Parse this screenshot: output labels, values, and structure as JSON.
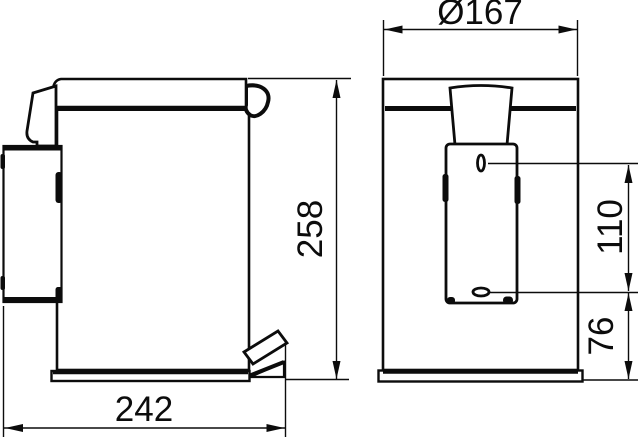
{
  "drawing": {
    "type": "technical-dimension-drawing",
    "views": {
      "side_view_label": "side view of pedal waste bin with wall bracket and foot pedal",
      "rear_view_label": "rear view of pedal waste bin with mounting plate and screw holes"
    },
    "dimensions": {
      "depth": "242",
      "height": "258",
      "diameter": "Ø167",
      "hole_spacing": "110",
      "lower_hole_height": "76"
    },
    "colors": {
      "line": "#0c0c0c",
      "background": "#ffffff"
    }
  }
}
